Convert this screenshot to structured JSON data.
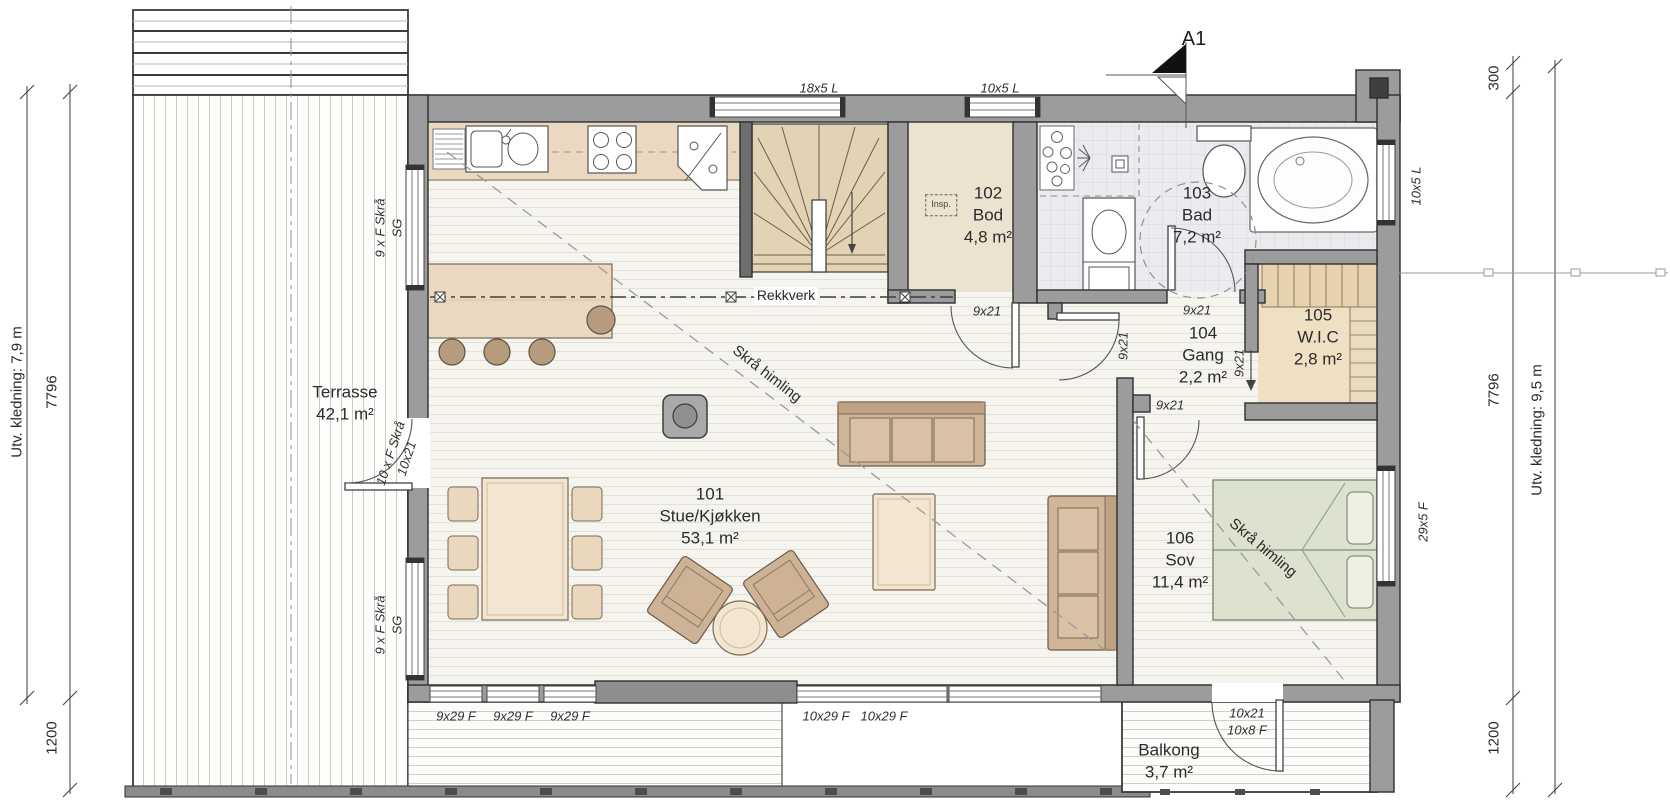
{
  "drawing": {
    "section_marker": "A1",
    "rooms": [
      {
        "number": "101",
        "name": "Stue/Kjøkken",
        "area": "53,1 m²"
      },
      {
        "number": "102",
        "name": "Bod",
        "area": "4,8 m²"
      },
      {
        "number": "103",
        "name": "Bad",
        "area": "7,2 m²"
      },
      {
        "number": "104",
        "name": "Gang",
        "area": "2,2 m²"
      },
      {
        "number": "105",
        "name": "W.I.C",
        "area": "2,8 m²"
      },
      {
        "number": "106",
        "name": "Sov",
        "area": "11,4 m²"
      }
    ],
    "outdoor": [
      {
        "name": "Terrasse",
        "area": "42,1 m²"
      },
      {
        "name": "Balkong",
        "area": "3,7 m²"
      }
    ],
    "annotations": {
      "railing": "Rekkverk",
      "sloped_ceiling_living": "Skrå himling",
      "sloped_ceiling_bedroom": "Skrå himling",
      "inspection_hatch": "Insp."
    },
    "window_labels": [
      {
        "label": "18x5 L"
      },
      {
        "label": "10x5 L"
      },
      {
        "label": "10x5 L"
      },
      {
        "label": "29x5 F"
      },
      {
        "label": "9 x F Skrå",
        "label2": "SG"
      },
      {
        "label": "9 x F Skrå",
        "label2": "SG"
      },
      {
        "label": "9x29 F"
      },
      {
        "label": "9x29 F"
      },
      {
        "label": "9x29 F"
      },
      {
        "label": "10x29 F"
      },
      {
        "label": "10x29 F"
      }
    ],
    "door_labels": [
      {
        "label": "9x21"
      },
      {
        "label": "9x21"
      },
      {
        "label": "9x21"
      },
      {
        "label": "9x21"
      },
      {
        "label": "9x21"
      },
      {
        "label": "10 x F Skrå",
        "label2": "10x21"
      },
      {
        "label": "10x21",
        "label2": "10x8 F"
      }
    ],
    "dimensions": {
      "left": [
        {
          "label": "Utv. kledning: 7,9 m"
        },
        {
          "label": "7796"
        },
        {
          "label": "1200"
        }
      ],
      "right": [
        {
          "label": "300"
        },
        {
          "label": "7796"
        },
        {
          "label": "1200"
        },
        {
          "label": "Utv. kledning: 9,5 m"
        }
      ]
    }
  }
}
